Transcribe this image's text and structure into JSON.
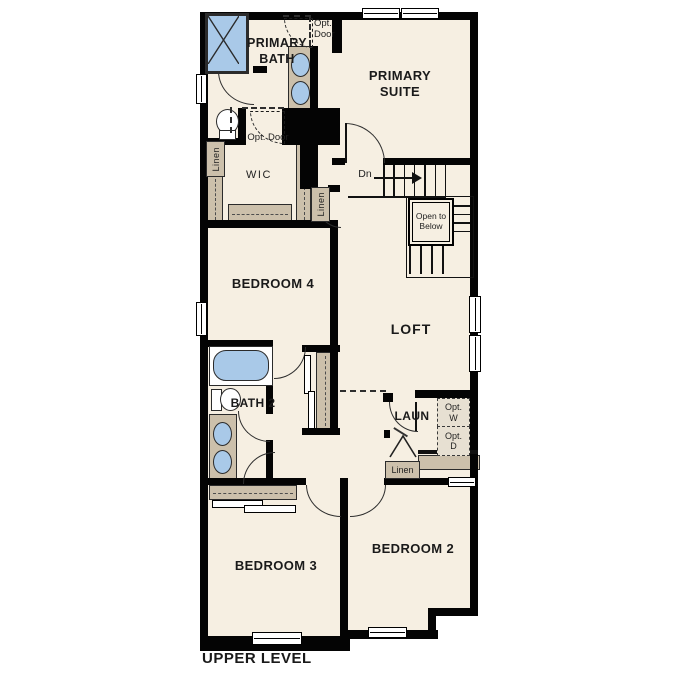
{
  "title": "UPPER LEVEL",
  "colors": {
    "floor": "#f6efe2",
    "walls": "#000000",
    "fixtures_blue": "#a9c9e8",
    "cabinetry_tan": "#ccc0ab",
    "background": "#ffffff"
  },
  "rooms": {
    "primary_suite": "PRIMARY SUITE",
    "primary_bath": "PRIMARY BATH",
    "wic": "WIC",
    "bedroom_4": "BEDROOM 4",
    "loft": "LOFT",
    "bath_2": "BATH 2",
    "laundry": "LAUN",
    "bedroom_3": "BEDROOM 3",
    "bedroom_2": "BEDROOM 2"
  },
  "annotations": {
    "opt_door_primary_suite": "Opt. Door",
    "opt_door_wic": "Opt. Door",
    "linen_primary_bath": "Linen",
    "linen_hall": "Linen",
    "linen_laundry": "Linen",
    "stairs_down": "Dn",
    "open_to_below": "Open to Below",
    "opt_washer": "Opt. W",
    "opt_dryer": "Opt. D"
  }
}
